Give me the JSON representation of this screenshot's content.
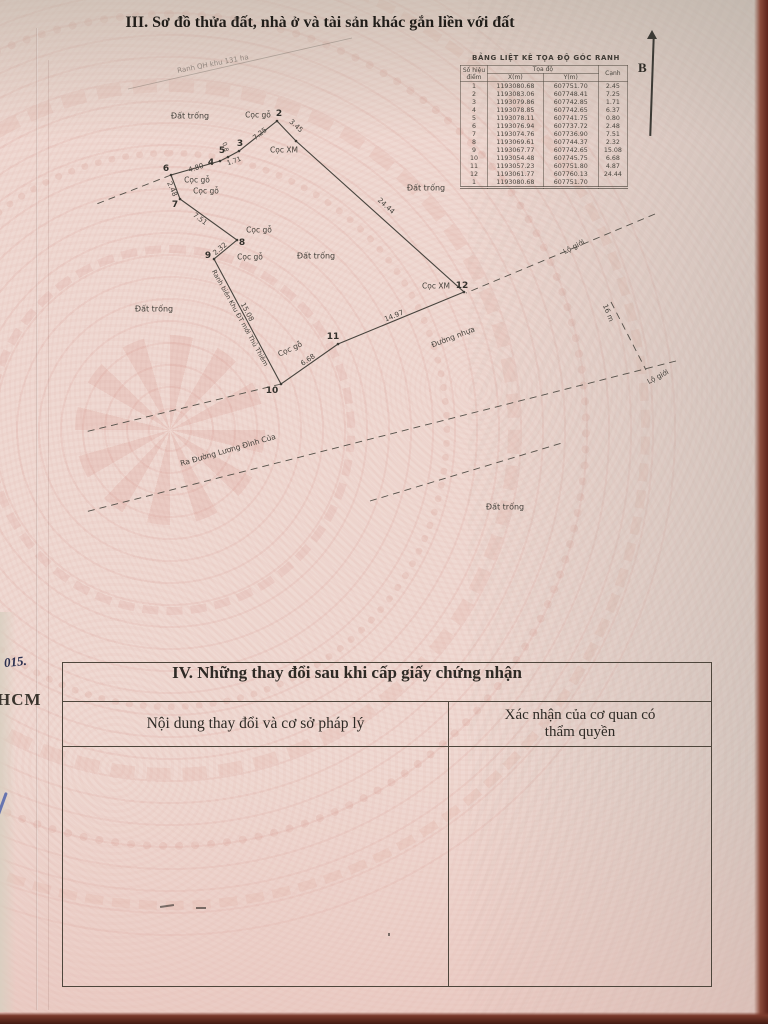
{
  "titles": {
    "section3": "III. Sơ đồ thửa đất, nhà ở và tài sản khác gắn liền với đất",
    "section4": "IV. Những thay đổi sau khi cấp giấy chứng nhận"
  },
  "north": {
    "label": "B"
  },
  "colors": {
    "paper": "#efd9d2",
    "ink": "#3f3c37",
    "table_border": "#4e463c",
    "photo_edge": "#5f241b",
    "pen_blue": "#3d55a8"
  },
  "coord_table": {
    "title": "BẢNG LIỆT KÊ TỌA ĐỘ GÓC RANH",
    "col_point": "Số hiệu điểm",
    "col_coord": "Tọa độ",
    "col_x": "X(m)",
    "col_y": "Y(m)",
    "col_edge": "Cạnh",
    "rows": [
      [
        "1",
        "1193080.68",
        "607751.70",
        "2.45"
      ],
      [
        "2",
        "1193083.06",
        "607748.41",
        "7.25"
      ],
      [
        "3",
        "1193079.86",
        "607742.85",
        "1.71"
      ],
      [
        "4",
        "1193078.85",
        "607742.65",
        "6.37"
      ],
      [
        "5",
        "1193078.11",
        "607741.75",
        "0.80"
      ],
      [
        "6",
        "1193076.94",
        "607737.72",
        "2.48"
      ],
      [
        "7",
        "1193074.76",
        "607736.90",
        "7.51"
      ],
      [
        "8",
        "1193069.61",
        "607744.37",
        "2.32"
      ],
      [
        "9",
        "1193067.77",
        "607742.65",
        "15.08"
      ],
      [
        "10",
        "1193054.48",
        "607745.75",
        "6.68"
      ],
      [
        "11",
        "1193057.23",
        "607751.80",
        "4.87"
      ],
      [
        "12",
        "1193061.77",
        "607760.13",
        "24.44"
      ],
      [
        "1",
        "1193080.68",
        "607751.70",
        ""
      ]
    ]
  },
  "changes_table": {
    "col_left": "Nội dung thay đổi và cơ sở pháp lý",
    "col_right": "Xác nhận của cơ quan có thẩm quyền"
  },
  "margin_notes": {
    "handwritten": "015.",
    "printed": "HCM"
  },
  "map": {
    "lines": {
      "polygon": [
        [
          296,
          141
        ],
        [
          277,
          121
        ],
        [
          239,
          151
        ],
        [
          228,
          157
        ],
        [
          220,
          161
        ],
        [
          171,
          175
        ],
        [
          180,
          199
        ],
        [
          237,
          240
        ],
        [
          214,
          259
        ],
        [
          281,
          384
        ],
        [
          338,
          344
        ],
        [
          464,
          292
        ]
      ],
      "dashed": [
        [
          [
            655,
            214
          ],
          [
            466,
            293
          ]
        ],
        [
          [
            281,
            384
          ],
          [
            85,
            432
          ]
        ],
        [
          [
            676,
            361
          ],
          [
            85,
            512
          ]
        ],
        [
          [
            611,
            302
          ],
          [
            646,
            370
          ]
        ],
        [
          [
            370,
            501
          ],
          [
            562,
            443
          ]
        ],
        [
          [
            171,
            175
          ],
          [
            94,
            205
          ]
        ]
      ],
      "faint": [
        [
          [
            128,
            89
          ],
          [
            352,
            38
          ]
        ]
      ]
    },
    "labels": [
      {
        "name": "label-dat-trong-nw",
        "text": "Đất trống",
        "x": 190,
        "y": 116,
        "rot": 0,
        "size": 8
      },
      {
        "name": "label-dat-trong-e",
        "text": "Đất trống",
        "x": 426,
        "y": 188,
        "rot": 0,
        "size": 8
      },
      {
        "name": "label-dat-trong-c",
        "text": "Đất trống",
        "x": 316,
        "y": 256,
        "rot": 0,
        "size": 8
      },
      {
        "name": "label-dat-trong-w",
        "text": "Đất trống",
        "x": 154,
        "y": 309,
        "rot": 0,
        "size": 8
      },
      {
        "name": "label-dat-trong-s",
        "text": "Đất trống",
        "x": 505,
        "y": 507,
        "rot": 0,
        "size": 8
      },
      {
        "name": "label-coc-go-p2",
        "text": "Cọc gỗ",
        "x": 258,
        "y": 115,
        "rot": 0,
        "size": 7.5
      },
      {
        "name": "label-coc-xm-p1",
        "text": "Cọc XM",
        "x": 284,
        "y": 150,
        "rot": 0,
        "size": 7.5
      },
      {
        "name": "label-coc-go-p6",
        "text": "Cọc gỗ",
        "x": 197,
        "y": 180,
        "rot": 0,
        "size": 7.5
      },
      {
        "name": "label-coc-go-p7",
        "text": "Cọc gỗ",
        "x": 206,
        "y": 191,
        "rot": 0,
        "size": 7.5
      },
      {
        "name": "label-coc-go-p8",
        "text": "Cọc gỗ",
        "x": 259,
        "y": 230,
        "rot": 0,
        "size": 7.5
      },
      {
        "name": "label-coc-go-p9",
        "text": "Cọc gỗ",
        "x": 250,
        "y": 257,
        "rot": 0,
        "size": 7.5
      },
      {
        "name": "label-coc-go-p10",
        "text": "Cọc gỗ",
        "x": 290,
        "y": 349,
        "rot": -25,
        "size": 7.5
      },
      {
        "name": "label-coc-xm-p12",
        "text": "Cọc XM",
        "x": 436,
        "y": 286,
        "rot": 0,
        "size": 7.5
      },
      {
        "name": "point-2",
        "text": "2",
        "x": 279,
        "y": 114,
        "rot": 0,
        "size": 9,
        "cls": "b"
      },
      {
        "name": "point-3",
        "text": "3",
        "x": 240,
        "y": 144,
        "rot": 0,
        "size": 9,
        "cls": "b"
      },
      {
        "name": "point-4",
        "text": "4",
        "x": 211,
        "y": 163,
        "rot": 0,
        "size": 9,
        "cls": "b"
      },
      {
        "name": "point-5",
        "text": "5",
        "x": 222,
        "y": 151,
        "rot": 0,
        "size": 9,
        "cls": "b"
      },
      {
        "name": "point-6",
        "text": "6",
        "x": 166,
        "y": 169,
        "rot": 0,
        "size": 9,
        "cls": "b"
      },
      {
        "name": "point-7",
        "text": "7",
        "x": 175,
        "y": 205,
        "rot": 0,
        "size": 9,
        "cls": "b"
      },
      {
        "name": "point-8",
        "text": "8",
        "x": 242,
        "y": 243,
        "rot": 0,
        "size": 9,
        "cls": "b"
      },
      {
        "name": "point-9",
        "text": "9",
        "x": 208,
        "y": 256,
        "rot": 0,
        "size": 9,
        "cls": "b"
      },
      {
        "name": "point-10",
        "text": "10",
        "x": 272,
        "y": 391,
        "rot": 0,
        "size": 9,
        "cls": "b"
      },
      {
        "name": "point-11",
        "text": "11",
        "x": 333,
        "y": 337,
        "rot": 0,
        "size": 9,
        "cls": "b"
      },
      {
        "name": "point-12",
        "text": "12",
        "x": 462,
        "y": 286,
        "rot": 0,
        "size": 9,
        "cls": "b"
      },
      {
        "name": "dim-1-2",
        "text": "3.45",
        "x": 296,
        "y": 126,
        "rot": 42,
        "size": 7,
        "cls": "dim"
      },
      {
        "name": "dim-2-3",
        "text": "7.25",
        "x": 260,
        "y": 134,
        "rot": -38,
        "size": 7,
        "cls": "dim"
      },
      {
        "name": "dim-3-4",
        "text": "1.71",
        "x": 234,
        "y": 161,
        "rot": -20,
        "size": 6.5,
        "cls": "dim"
      },
      {
        "name": "dim-4-5",
        "text": "0.8",
        "x": 225,
        "y": 147,
        "rot": 75,
        "size": 6,
        "cls": "dim"
      },
      {
        "name": "dim-5-6",
        "text": "4.80",
        "x": 196,
        "y": 168,
        "rot": -17,
        "size": 7,
        "cls": "dim"
      },
      {
        "name": "dim-6-7",
        "text": "2.48",
        "x": 172,
        "y": 189,
        "rot": 66,
        "size": 7,
        "cls": "dim"
      },
      {
        "name": "dim-7-8",
        "text": "7.51",
        "x": 200,
        "y": 219,
        "rot": 36,
        "size": 7,
        "cls": "dim"
      },
      {
        "name": "dim-8-9",
        "text": "2.32",
        "x": 220,
        "y": 249,
        "rot": -40,
        "size": 7,
        "cls": "dim"
      },
      {
        "name": "dim-9-10",
        "text": "15.08",
        "x": 247,
        "y": 312,
        "rot": 62,
        "size": 7,
        "cls": "dim"
      },
      {
        "name": "dim-10-11",
        "text": "6.68",
        "x": 308,
        "y": 360,
        "rot": -34,
        "size": 7,
        "cls": "dim"
      },
      {
        "name": "dim-11-12",
        "text": "14.97",
        "x": 394,
        "y": 316,
        "rot": -22,
        "size": 7,
        "cls": "dim"
      },
      {
        "name": "dim-12-1",
        "text": "24.44",
        "x": 386,
        "y": 206,
        "rot": 42,
        "size": 7,
        "cls": "dim"
      },
      {
        "name": "label-duong-nhua",
        "text": "Đường nhựa",
        "x": 453,
        "y": 337,
        "rot": -21,
        "size": 7.5
      },
      {
        "name": "label-lo-gioi-1",
        "text": "Lộ giới",
        "x": 574,
        "y": 247,
        "rot": -28,
        "size": 7
      },
      {
        "name": "label-lo-gioi-2",
        "text": "Lộ giới",
        "x": 658,
        "y": 377,
        "rot": -28,
        "size": 7
      },
      {
        "name": "dim-road-width",
        "text": "16 m",
        "x": 608,
        "y": 313,
        "rot": 68,
        "size": 7,
        "cls": "dim"
      },
      {
        "name": "label-ranh-bien",
        "text": "Ranh biên Khu ĐT mới Thủ Thiêm",
        "x": 240,
        "y": 318,
        "rot": 61,
        "size": 6.5
      },
      {
        "name": "label-ra-duong",
        "text": "Ra Đường Lương Đình Của",
        "x": 228,
        "y": 450,
        "rot": -16,
        "size": 7.5
      },
      {
        "name": "label-ranh-qh",
        "text": "Ranh QH khu 131 ha",
        "x": 213,
        "y": 64,
        "rot": -11,
        "size": 7,
        "cls": "faint"
      }
    ]
  }
}
